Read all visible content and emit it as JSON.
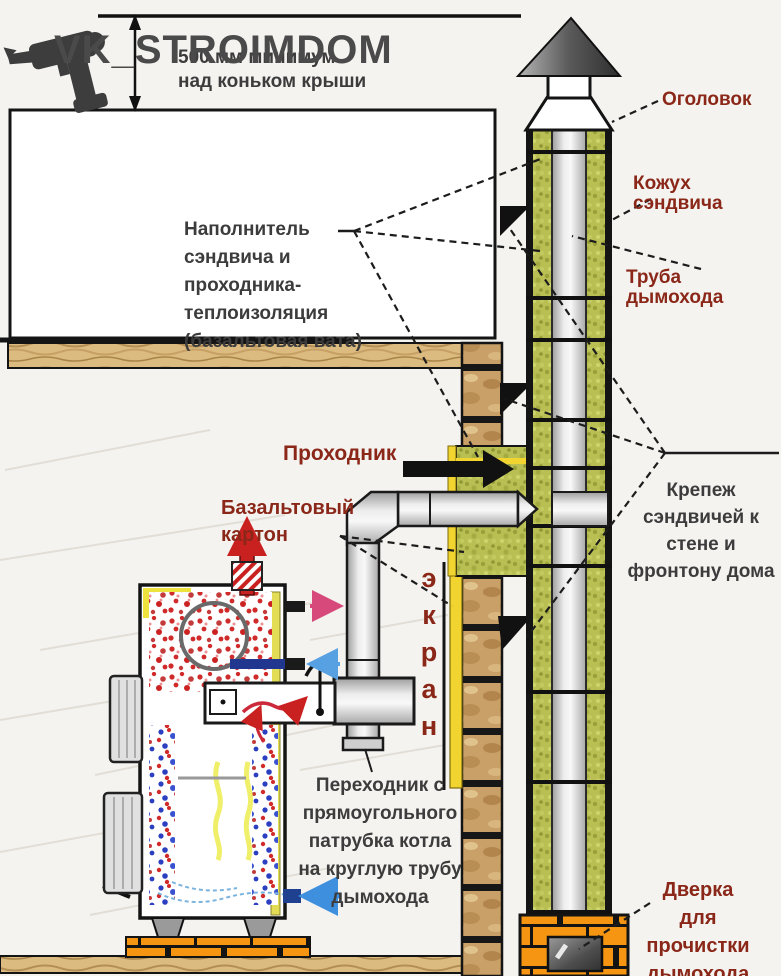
{
  "watermark": {
    "brand": "VK_STROIMDOM"
  },
  "dimension_note": {
    "line1": "500 мм минимум",
    "line2": "над коньком крыши"
  },
  "labels": {
    "ogolovok": "Оголовок",
    "kozhuh": "Кожух сэндвича",
    "truba": "Труба дымохода",
    "napolnitel": {
      "lines": [
        "Наполнитель",
        "сэндвича и",
        "проходника-",
        "теплоизоляция",
        "(базальтовая вата)"
      ]
    },
    "prohodnik": "Проходник",
    "bazalt": {
      "lines": [
        "Базальтовый",
        "картон"
      ]
    },
    "ekran": {
      "letters": [
        "э",
        "к",
        "р",
        "а",
        "н"
      ]
    },
    "krepezh": {
      "lines": [
        "Крепеж",
        "сэндвичей к",
        "стене и",
        "фронтону дома"
      ]
    },
    "perehodnik": {
      "lines": [
        "Переходник с",
        "прямоугольного",
        "патрубка котла",
        "на круглую трубу",
        "дымохода"
      ]
    },
    "dverka": {
      "lines": [
        "Дверка",
        "для",
        "прочистки",
        "дымохода"
      ]
    }
  },
  "colors": {
    "label_accent": "#8a2718",
    "label_dark": "#3c3c3c",
    "insulation_green": "#b9bf52",
    "wall_brick_tan": "#c9a067",
    "base_brick_orange": "#f59511",
    "wood": "#dcbb80",
    "screen_yellow": "#f2d430",
    "pipe_gray": "#c9c9c9",
    "flame_red": "#c92020",
    "water_blue": "#2b3fc0"
  }
}
